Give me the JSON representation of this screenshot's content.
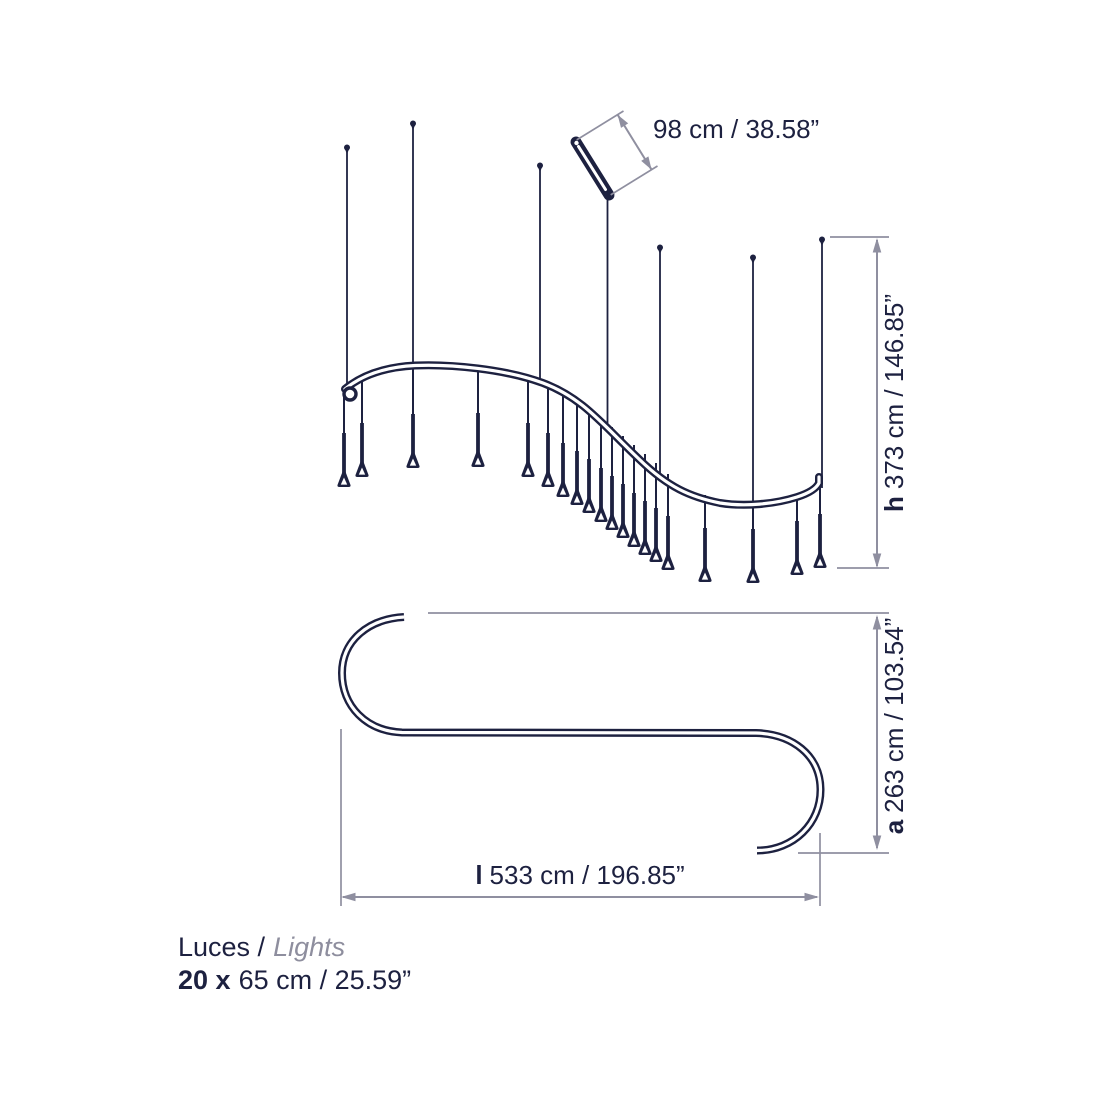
{
  "colors": {
    "ink": "#1d2140",
    "dimension_line": "#8f8fa0",
    "muted_text": "#8e8e9e",
    "background": "#ffffff"
  },
  "dimensions": {
    "rod_length": {
      "value": "98 cm / 38.58”"
    },
    "height": {
      "symbol": "h",
      "value": "373 cm / 146.85”"
    },
    "depth": {
      "symbol": "a",
      "value": "263 cm / 103.54”"
    },
    "length": {
      "symbol": "l",
      "value": "533 cm / 196.85”"
    }
  },
  "legend": {
    "label_es": "Luces /",
    "label_en": "Lights",
    "count": "20 x",
    "size": "65 cm / 25.59”"
  }
}
